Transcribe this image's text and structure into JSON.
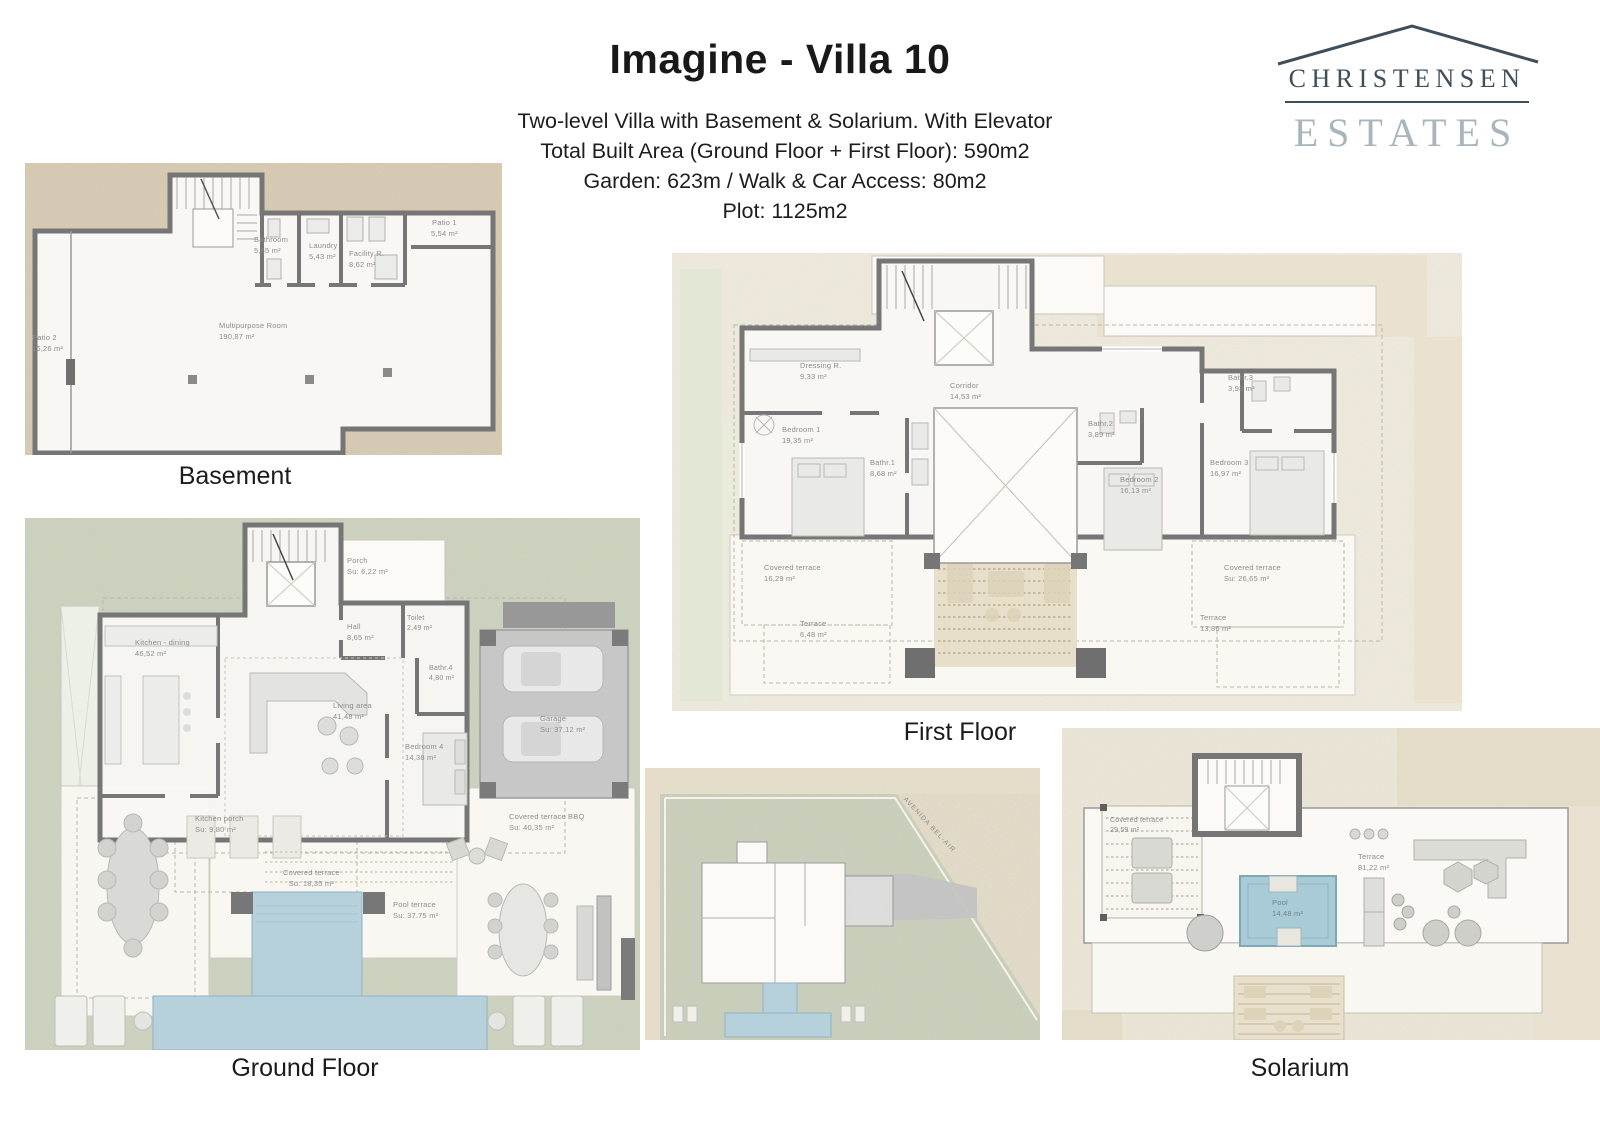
{
  "header": {
    "title": "Imagine - Villa 10",
    "subtitle_lines": [
      "Two-level Villa with Basement & Solarium. With Elevator",
      "Total Built Area (Ground Floor + First Floor):  590m2",
      "Garden: 623m  /  Walk & Car Access: 80m2",
      "Plot: 1125m2"
    ]
  },
  "logo": {
    "line1": "CHRISTENSEN",
    "line2": "ESTATES",
    "color_dark": "#3e4e5a",
    "color_light": "#a9b5bd"
  },
  "plans": {
    "basement": {
      "caption": "Basement",
      "rooms": [
        {
          "name": "Patio 2",
          "area": "16,26 m²"
        },
        {
          "name": "Bathroom",
          "area": "5,65 m²"
        },
        {
          "name": "Laundry",
          "area": "5,43 m²"
        },
        {
          "name": "Facility R.",
          "area": "8,62 m²"
        },
        {
          "name": "Patio 1",
          "area": "5,54 m²"
        },
        {
          "name": "Multipurpose Room",
          "area": "190,87 m²"
        }
      ]
    },
    "first_floor": {
      "caption": "First Floor",
      "rooms": [
        {
          "name": "Dressing R.",
          "area": "9,33 m²"
        },
        {
          "name": "Corridor",
          "area": "14,53 m²"
        },
        {
          "name": "Bedroom 1",
          "area": "19,35 m²"
        },
        {
          "name": "Bathr.1",
          "area": "8,68 m²"
        },
        {
          "name": "Bathr.2",
          "area": "3,89 m²"
        },
        {
          "name": "Bathr.3",
          "area": "3,93 m²"
        },
        {
          "name": "Bedroom 2",
          "area": "16,13 m²"
        },
        {
          "name": "Bedroom 3",
          "area": "16,97 m²"
        },
        {
          "name": "Covered terrace",
          "area": "16,29 m²"
        },
        {
          "name": "Terrace",
          "area": "6,48 m²"
        },
        {
          "name": "Covered terrace",
          "area": "Su: 26,65 m²"
        },
        {
          "name": "Terrace",
          "area": "13,86 m²"
        }
      ]
    },
    "ground_floor": {
      "caption": "Ground Floor",
      "rooms": [
        {
          "name": "Porch",
          "area": "Su: 6,22 m²"
        },
        {
          "name": "Kitchen - dining",
          "area": "46,52 m²"
        },
        {
          "name": "Hall",
          "area": "8,65 m²"
        },
        {
          "name": "Toilet",
          "area": "2,49 m²"
        },
        {
          "name": "Bathr.4",
          "area": "4,80 m²"
        },
        {
          "name": "Living area",
          "area": "41,48 m²"
        },
        {
          "name": "Bedroom 4",
          "area": "14,38 m²"
        },
        {
          "name": "Garage",
          "area": "Su: 37,12 m²"
        },
        {
          "name": "Kitchen porch",
          "area": "Su: 9,80 m²"
        },
        {
          "name": "Covered terrace BBQ",
          "area": "Su: 40,35 m²"
        },
        {
          "name": "Covered terrace",
          "area": "Su: 18,35 m²"
        },
        {
          "name": "Pool terrace",
          "area": "Su: 37.75 m²"
        }
      ]
    },
    "site_plan": {
      "road_label": "AVENIDA BEL-AIR"
    },
    "solarium": {
      "caption": "Solarium",
      "rooms": [
        {
          "name": "Covered terrace",
          "area": "29,59 m²"
        },
        {
          "name": "Terrace",
          "area": "81,22 m²"
        },
        {
          "name": "Pool",
          "area": "14,48 m²"
        }
      ]
    }
  },
  "colors": {
    "wall": "#767676",
    "sand": "#d9ccb5",
    "sage": "#ced4c1",
    "cream": "#f0ebdf",
    "cream2": "#ece7d8",
    "pool": "#b6d1db",
    "label": "#8d8d8d"
  }
}
